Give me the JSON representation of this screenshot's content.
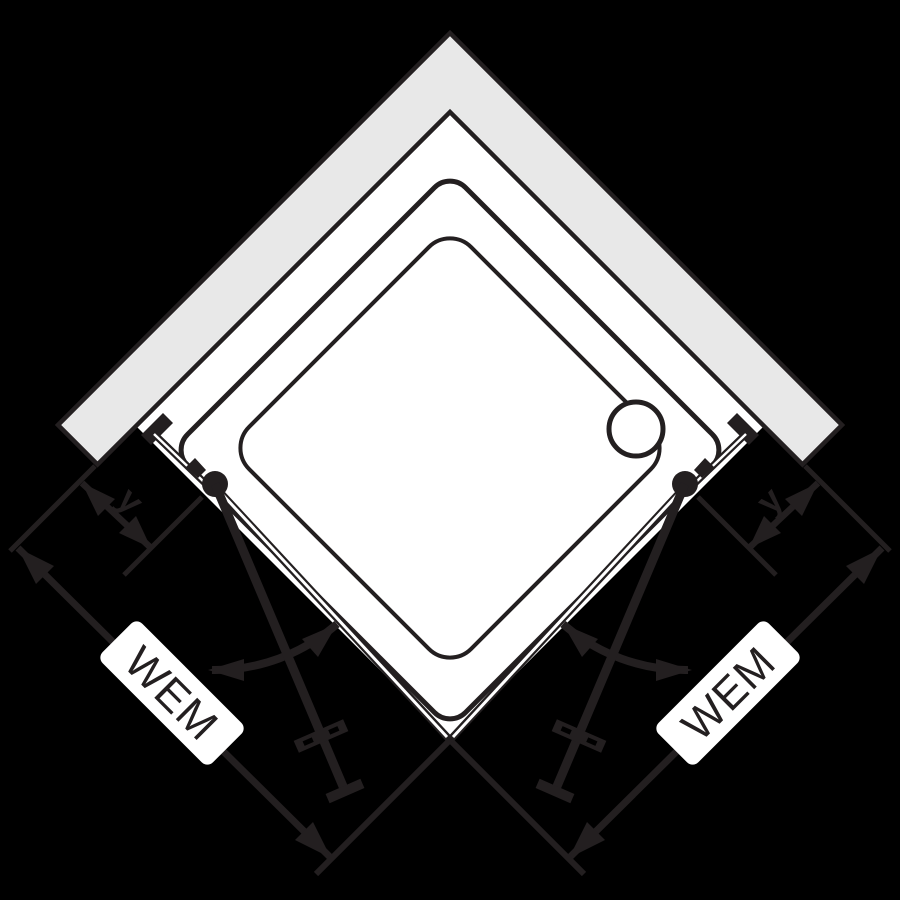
{
  "colors": {
    "background": "#000000",
    "ink": "#231f20",
    "wall_fill": "#e8e8e8",
    "panel_fill": "#ffffff"
  },
  "diagram": {
    "title": "Corner-entry shower enclosure with two pivot doors, top view",
    "labels": {
      "wem_left": "WEM",
      "wem_right": "WEM",
      "y_left": "y",
      "y_right": "y"
    },
    "icons": {
      "drain": "drain-circle-icon",
      "swing_left": "door-swing-arc-icon",
      "swing_right": "door-swing-arc-icon"
    }
  }
}
